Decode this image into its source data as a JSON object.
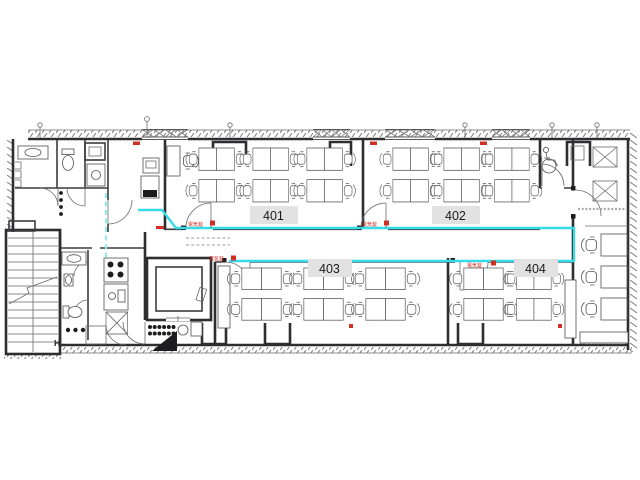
{
  "rooms": [
    {
      "label": "401"
    },
    {
      "label": "402"
    },
    {
      "label": "403"
    },
    {
      "label": "404"
    }
  ],
  "annotations": {
    "door_lock": "電気錠",
    "entrance_marker": "H"
  },
  "colors": {
    "wall": "#2e2e30",
    "furniture_line": "#58595b",
    "security_line": "#35dce8",
    "security_line_dashed": "#8feef3",
    "annotation_red": "#d03024",
    "label_bg": "#e2e2e2",
    "label_text": "#1b1b1b"
  }
}
